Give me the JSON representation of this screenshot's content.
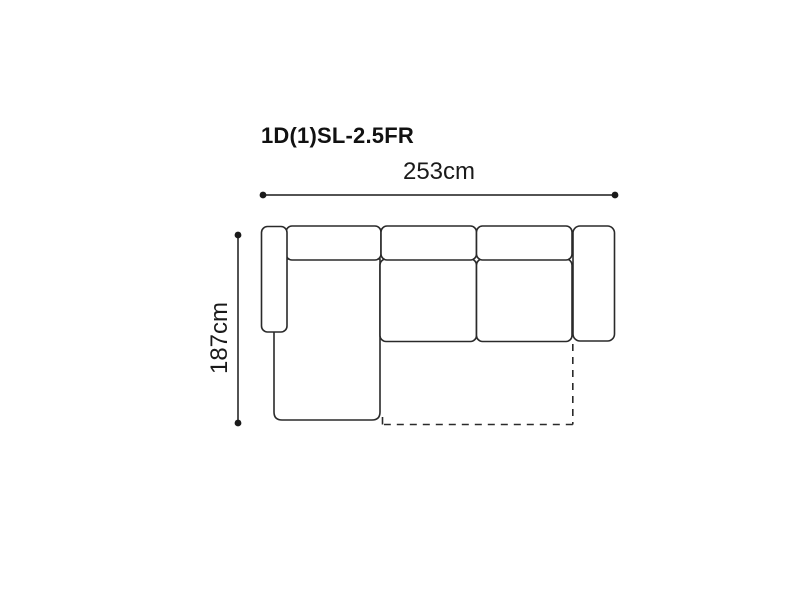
{
  "diagram": {
    "product_code": "1D(1)SL-2.5FR",
    "width_dimension_label": "253cm",
    "depth_dimension_label": "187cm",
    "line_color": "#2a2a2a",
    "dimension_line_color": "#1a1a1a",
    "fill_color": "#ffffff",
    "text_color": "#1a1a1a",
    "background_color": "#ffffff"
  }
}
